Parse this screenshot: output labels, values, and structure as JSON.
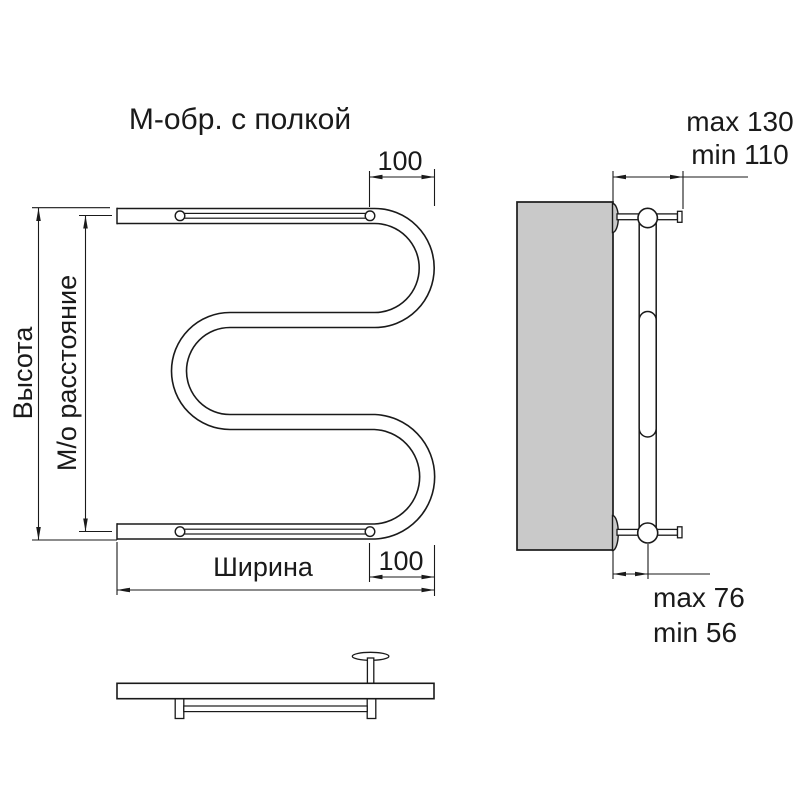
{
  "title": "М-обр. с полкой",
  "colors": {
    "line": "#1a1a1a",
    "wall_fill": "#c9c9c9",
    "background": "#ffffff"
  },
  "front_view": {
    "dims": {
      "height_label": "Высота",
      "axis_label": "М/о расстояние",
      "width_label": "Ширина",
      "top_right_offset": "100",
      "bottom_right_offset": "100"
    }
  },
  "side_view": {
    "dims": {
      "top_max": "max 130",
      "top_min": "min 110",
      "bottom_max": "max 76",
      "bottom_min": "min 56"
    }
  }
}
